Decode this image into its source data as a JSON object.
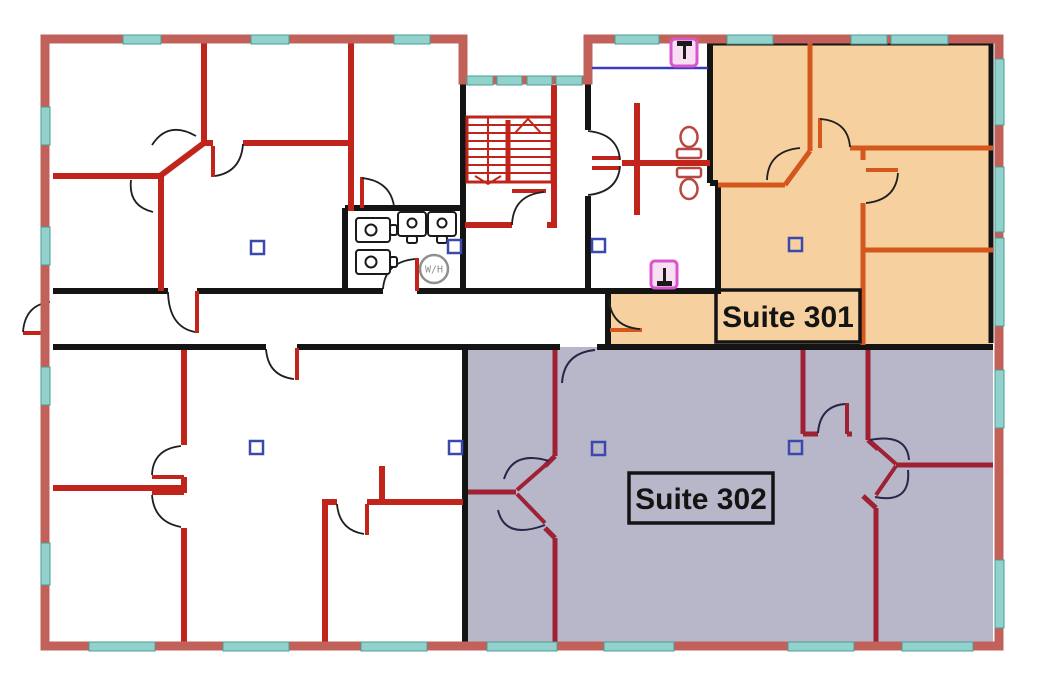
{
  "page": {
    "background": "#ffffff"
  },
  "labels": {
    "suite_301": "Suite 301",
    "suite_302": "Suite 302",
    "water_heater": "W/H"
  },
  "colors": {
    "background": "#ffffff",
    "outer_wall": "#c2605a",
    "window_fill": "#93d2cc",
    "window_stroke": "#4a9d96",
    "wall_black": "#141414",
    "wall_red": "#c0241a",
    "suite301_fill": "#f6d09e",
    "suite301_wall": "#d4571d",
    "suite302_fill": "#b8b6c9",
    "suite302_wall": "#9e2134",
    "door_arc": "#1f1f1f",
    "door_arc_navy": "#26264a",
    "fixture_outline": "#1a1a1a",
    "toilet_red": "#b8473f",
    "marker_blue": "#3b49ad",
    "magenta": "#d956cc",
    "magenta_fill": "#f7def3",
    "counter_blue": "#3b3bbf",
    "wh_gray": "#8f8f8f",
    "label_text": "#141414"
  },
  "icons": {
    "toilet": "toilet-icon",
    "sink": "sink-icon",
    "highlighted_sink": "sink-marker-icon",
    "water_heater": "water-heater-icon",
    "device_marker": "blue-square-marker-icon",
    "stairs": "staircase-icon",
    "door": "door-swing-arc-icon",
    "window": "window-segment"
  }
}
